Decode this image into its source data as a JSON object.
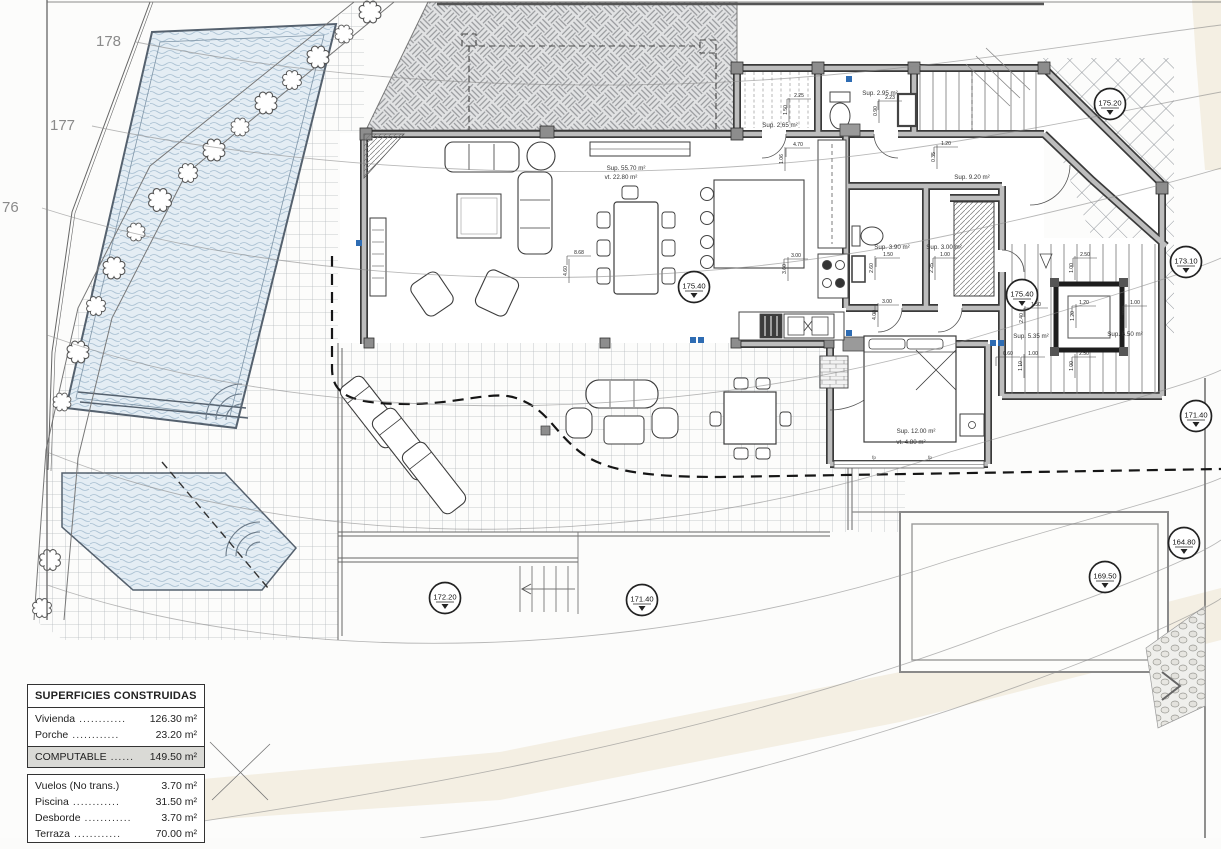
{
  "contour_labels": [
    {
      "text": "178"
    },
    {
      "text": "177"
    },
    {
      "text": "76"
    }
  ],
  "level_markers": [
    {
      "value": "175.20"
    },
    {
      "value": "173.10"
    },
    {
      "value": "175.40"
    },
    {
      "value": "175.40"
    },
    {
      "value": "171.40"
    },
    {
      "value": "172.20"
    },
    {
      "value": "171.40"
    },
    {
      "value": "169.50"
    },
    {
      "value": "164.80"
    }
  ],
  "room_labels": [
    {
      "line1": "Sup. 55.70 m²",
      "line2": "vt.  22.80 m²"
    },
    {
      "line1": "Sup. 2.65 m²"
    },
    {
      "line1": "Sup. 2.95 m²"
    },
    {
      "line1": "Sup. 9.20 m²"
    },
    {
      "line1": "Sup. 3.90 m²"
    },
    {
      "line1": "Sup. 3.00 m²"
    },
    {
      "line1": "Sup. 12.00 m²",
      "line2": "vt.   4.80 m²"
    },
    {
      "line1": "Sup. 5.35 m²"
    },
    {
      "line1": "Sup. 6.50 m²"
    }
  ],
  "dimensions": [
    "8.68",
    "4.60",
    "4.70",
    "1.06",
    "2.25",
    "1.50",
    "2.23",
    "0.90",
    "1.20",
    "0.35",
    "3.00",
    "3.60",
    "3.00",
    "4.00",
    "1.50",
    "2.60",
    "1.00",
    "2.25",
    "2.50",
    "1.00",
    "1.20",
    "1.20",
    "1.00",
    "1.90",
    "1.50",
    "2.40",
    "0.60",
    "1.00",
    "1.10",
    "2.50",
    "1.00"
  ],
  "bed_tags": [
    "fp",
    "fp"
  ],
  "legend": {
    "title": "SUPERFICIES CONSTRUIDAS",
    "rows_top": [
      {
        "label": "Vivienda",
        "dots": "............",
        "value": "126.30 m²"
      },
      {
        "label": "Porche",
        "dots": "............",
        "value": "23.20 m²"
      }
    ],
    "row_computable": {
      "label": "COMPUTABLE",
      "dots": "......",
      "value": "149.50 m²"
    },
    "rows_bottom": [
      {
        "label": "Vuelos (No trans.)",
        "dots": "",
        "value": "3.70 m²"
      },
      {
        "label": "Piscina",
        "dots": "............",
        "value": "31.50 m²"
      },
      {
        "label": "Desborde",
        "dots": "............",
        "value": "3.70 m²"
      },
      {
        "label": "Terraza",
        "dots": "............",
        "value": "70.00 m²"
      }
    ]
  },
  "colors": {
    "wall_dark": "#3f3f3f",
    "wall_fill": "#bdbdbd",
    "water_fill": "#e4edf4",
    "window_tag_blue": "#2e6cb3",
    "terrain_beige": "#ece4cf",
    "computable_row_bg": "#dadad6"
  }
}
